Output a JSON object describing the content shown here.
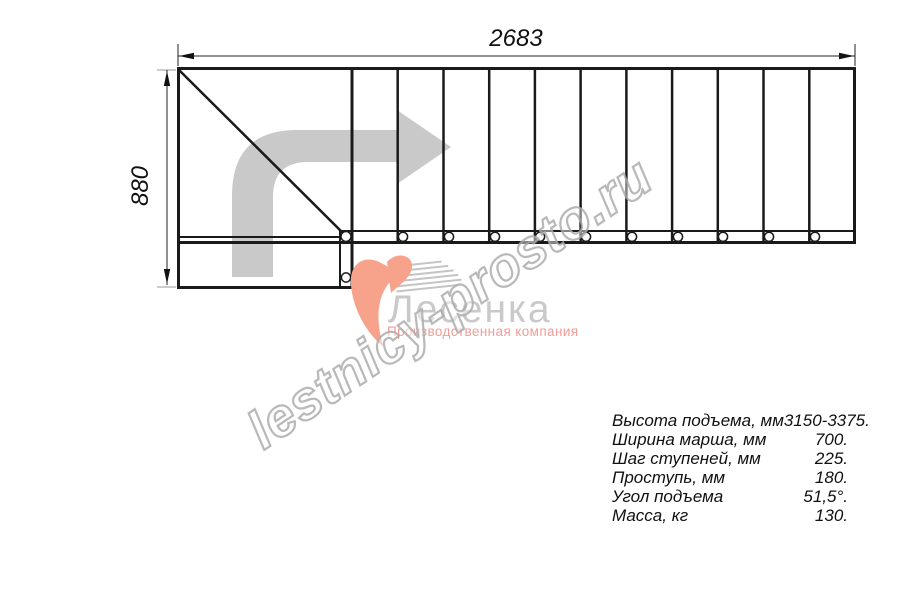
{
  "drawing": {
    "dim_width": "2683",
    "dim_height": "880"
  },
  "watermark": {
    "text": "lestnicy-prosto.ru"
  },
  "logo": {
    "name": "Лесенка",
    "tagline": "Производственная компания"
  },
  "specs": {
    "rows": [
      {
        "label": "Высота подъема, мм",
        "value": "3150-3375."
      },
      {
        "label": "Ширина марша, мм",
        "value": "700."
      },
      {
        "label": "Шаг ступеней, мм",
        "value": "225."
      },
      {
        "label": "Проступь, мм",
        "value": "180."
      },
      {
        "label": "Угол подъема",
        "value": "51,5°."
      },
      {
        "label": "Масса, кг",
        "value": "130."
      }
    ]
  },
  "colors": {
    "line": "#1a1a1a",
    "direction_arrow": "#c9c9c9",
    "watermark_outline": "#a8a8a8",
    "logo_accent": "#f7a38c",
    "logo_text": "#c9c9c9",
    "logo_tagline": "#ef9d96"
  }
}
